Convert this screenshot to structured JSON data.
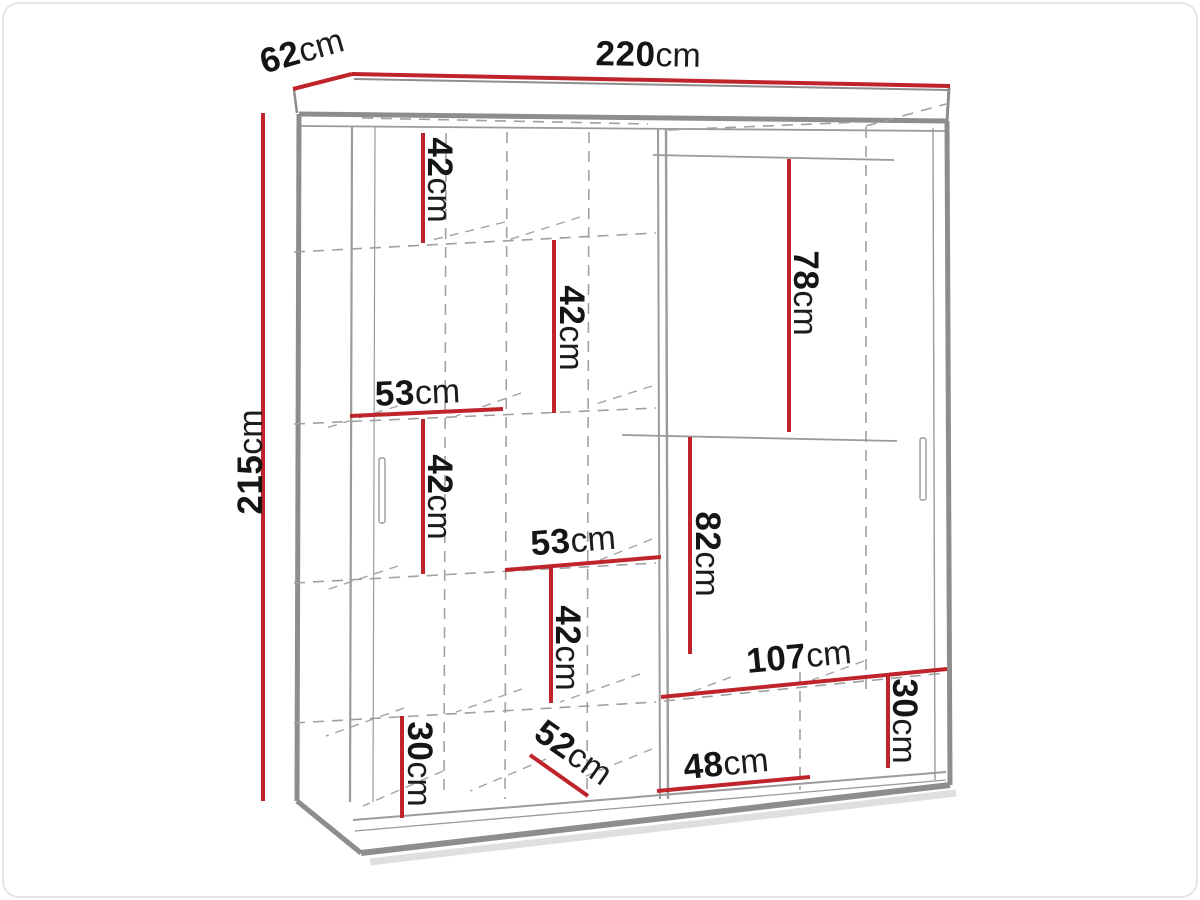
{
  "diagram": {
    "unit": "cm",
    "colors": {
      "dimension_line": "#bf242b",
      "outline_gray": "#8d8d8d",
      "hidden_line_gray": "#a0a0a0",
      "label_text": "#151515",
      "background": "#ffffff"
    },
    "dims": {
      "width": {
        "value": "220",
        "unit": "cm"
      },
      "depth": {
        "value": "62",
        "unit": "cm"
      },
      "height": {
        "value": "215",
        "unit": "cm"
      },
      "gap_top_left": {
        "value": "42",
        "unit": "cm"
      },
      "gap_upper_mid": {
        "value": "42",
        "unit": "cm"
      },
      "shelf_width_left": {
        "value": "53",
        "unit": "cm"
      },
      "gap_mid_left": {
        "value": "42",
        "unit": "cm"
      },
      "shelf_width_mid": {
        "value": "53",
        "unit": "cm"
      },
      "gap_lower_mid": {
        "value": "42",
        "unit": "cm"
      },
      "gap_bottom_left": {
        "value": "30",
        "unit": "cm"
      },
      "interior_depth": {
        "value": "52",
        "unit": "cm"
      },
      "hanging_right_top": {
        "value": "78",
        "unit": "cm"
      },
      "hanging_right_mid": {
        "value": "82",
        "unit": "cm"
      },
      "shelf_width_right": {
        "value": "107",
        "unit": "cm"
      },
      "gap_bottom_right": {
        "value": "30",
        "unit": "cm"
      },
      "niche_width_right": {
        "value": "48",
        "unit": "cm"
      }
    }
  }
}
